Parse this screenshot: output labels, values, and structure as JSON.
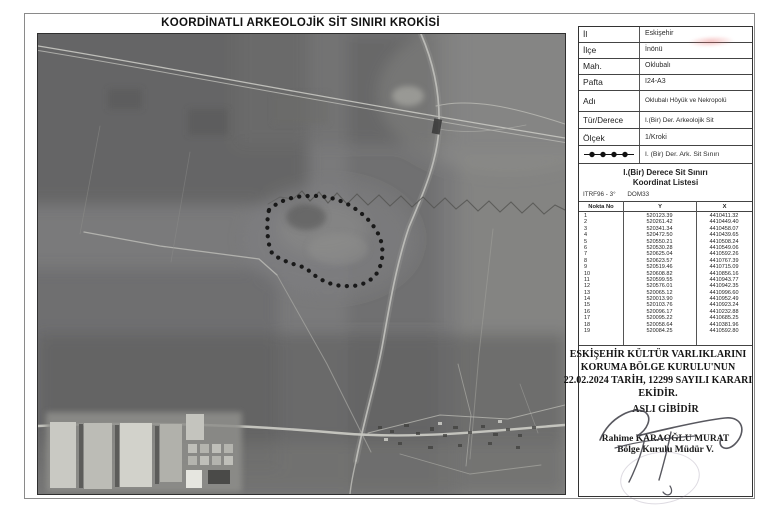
{
  "page": {
    "title": "KOORDİNATLI ARKEOLOJİK SİT SINIRI KROKİSİ"
  },
  "info_table": {
    "rows": [
      {
        "label": "İl",
        "value": "Eskişehir"
      },
      {
        "label": "İlçe",
        "value": "İnönü"
      },
      {
        "label": "Mah.",
        "value": "Oklubalı"
      },
      {
        "label": "Pafta",
        "value": "I24-A3"
      },
      {
        "label": "Adı",
        "value": "Oklubalı Höyük ve Nekropolü"
      },
      {
        "label": "Tür/Derece",
        "value": "I.(Bir) Der. Arkeolojik Sit"
      },
      {
        "label": "Ölçek",
        "value": "1/Kroki"
      }
    ],
    "legend": {
      "symbol": "dotted-boundary-line",
      "label": "I. (Bir) Der. Ark. Sit Sınırı"
    }
  },
  "coordinate_list": {
    "title_line1": "I.(Bir) Derece Sit Sınırı",
    "title_line2": "Koordinat Listesi",
    "datum_system": "ITRF96 - 3°",
    "datum_zone": "DOM33",
    "columns": [
      "Nokta No",
      "Y",
      "X"
    ],
    "rows": [
      [
        "1",
        "520123.39",
        "4410411.32"
      ],
      [
        "2",
        "520261.42",
        "4410449.40"
      ],
      [
        "3",
        "520341.34",
        "4410458.07"
      ],
      [
        "4",
        "520472.50",
        "4410439.65"
      ],
      [
        "5",
        "520550.21",
        "4410508.24"
      ],
      [
        "6",
        "520530.28",
        "4410549.06"
      ],
      [
        "7",
        "520625.04",
        "4410592.26"
      ],
      [
        "8",
        "520623.57",
        "4410767.39"
      ],
      [
        "9",
        "520519.46",
        "4410715.09"
      ],
      [
        "10",
        "520608.82",
        "4410856.16"
      ],
      [
        "11",
        "520599.55",
        "4410943.77"
      ],
      [
        "12",
        "520576.01",
        "4410942.35"
      ],
      [
        "13",
        "520065.12",
        "4410996.60"
      ],
      [
        "14",
        "520013.90",
        "4410952.49"
      ],
      [
        "15",
        "520103.76",
        "4410923.24"
      ],
      [
        "16",
        "520096.17",
        "4410232.88"
      ],
      [
        "17",
        "520095.22",
        "4410685.25"
      ],
      [
        "18",
        "520058.64",
        "4410381.96"
      ],
      [
        "19",
        "520084.25",
        "4410592.80"
      ]
    ]
  },
  "footer": {
    "decision_lines": [
      "ESKİŞEHİR KÜLTÜR VARLIKLARINI",
      "KORUMA BÖLGE KURULU'NUN",
      "22.02.2024 TARİH, 12299 SAYILI KARARI",
      "EKİDİR."
    ],
    "certify_stamp": "ASLI GİBİDİR",
    "signatory_name": "Rahime KARAOĞLU MURAT",
    "signatory_title": "Bölge Kurulu Müdür V."
  },
  "map": {
    "boundary_dot_color": "#101010",
    "photo_tone": "#7a7a7b"
  }
}
